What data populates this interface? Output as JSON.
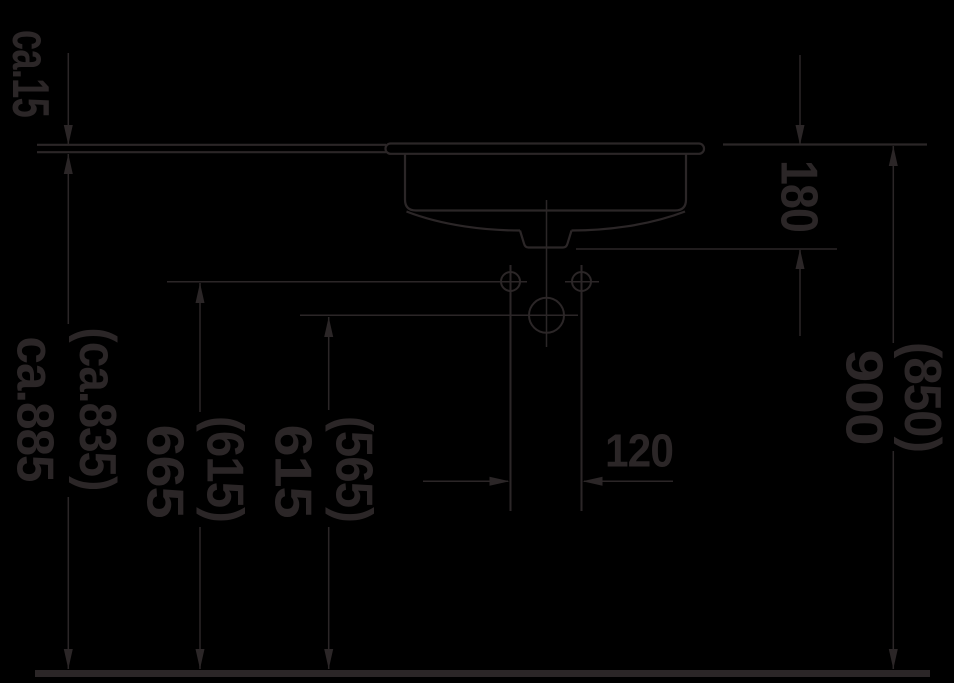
{
  "drawing": {
    "type": "washbasin-installation-side-view",
    "dimensions": {
      "countertop_thickness": {
        "value": "ca.15"
      },
      "height_under_counter": {
        "value": "ca.885",
        "alt": "(ca.835)"
      },
      "height_upper_holes": {
        "value": "665",
        "alt": "(615)"
      },
      "height_drain_center": {
        "value": "615",
        "alt": "(565)"
      },
      "pipe_width": {
        "value": "120"
      },
      "basin_depth": {
        "value": "180"
      },
      "height_counter_top": {
        "value": "900",
        "alt": "(850)"
      }
    },
    "colors": {
      "background": "#000000",
      "line": "#2b2627"
    }
  }
}
